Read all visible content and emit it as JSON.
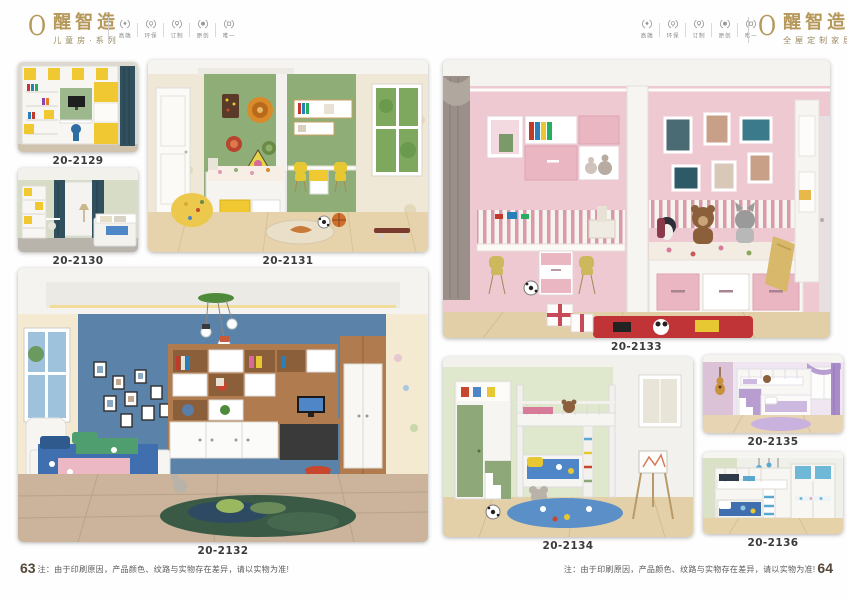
{
  "brand_left": {
    "mark": "O",
    "name": "醒智造",
    "subtitle": "儿童房·系列"
  },
  "brand_right": {
    "mark": "O",
    "name": "醒智造",
    "subtitle": "全屋定制家居"
  },
  "badges": [
    {
      "label": "高端",
      "icon": "laurel-wreath-icon"
    },
    {
      "label": "环保",
      "icon": "laurel-wreath-icon"
    },
    {
      "label": "订制",
      "icon": "laurel-wreath-icon"
    },
    {
      "label": "原创",
      "icon": "laurel-wreath-icon"
    },
    {
      "label": "唯一",
      "icon": "laurel-wreath-icon"
    }
  ],
  "photos": [
    {
      "code": "20-2129"
    },
    {
      "code": "20-2130"
    },
    {
      "code": "20-2131"
    },
    {
      "code": "20-2132"
    },
    {
      "code": "20-2133"
    },
    {
      "code": "20-2134"
    },
    {
      "code": "20-2135"
    },
    {
      "code": "20-2136"
    }
  ],
  "footer_left": {
    "page_number": "63",
    "note": "注：由于印刷原因，产品颜色、纹路与实物存在差异，请以实物为准!"
  },
  "footer_right": {
    "page_number": "64",
    "note": "注：由于印刷原因，产品颜色、纹路与实物存在差异，请以实物为准!"
  },
  "colors": {
    "logo_gold": "#b5985a",
    "caption_text": "#3a3a3a",
    "badge_gray": "#8a8a8a"
  }
}
